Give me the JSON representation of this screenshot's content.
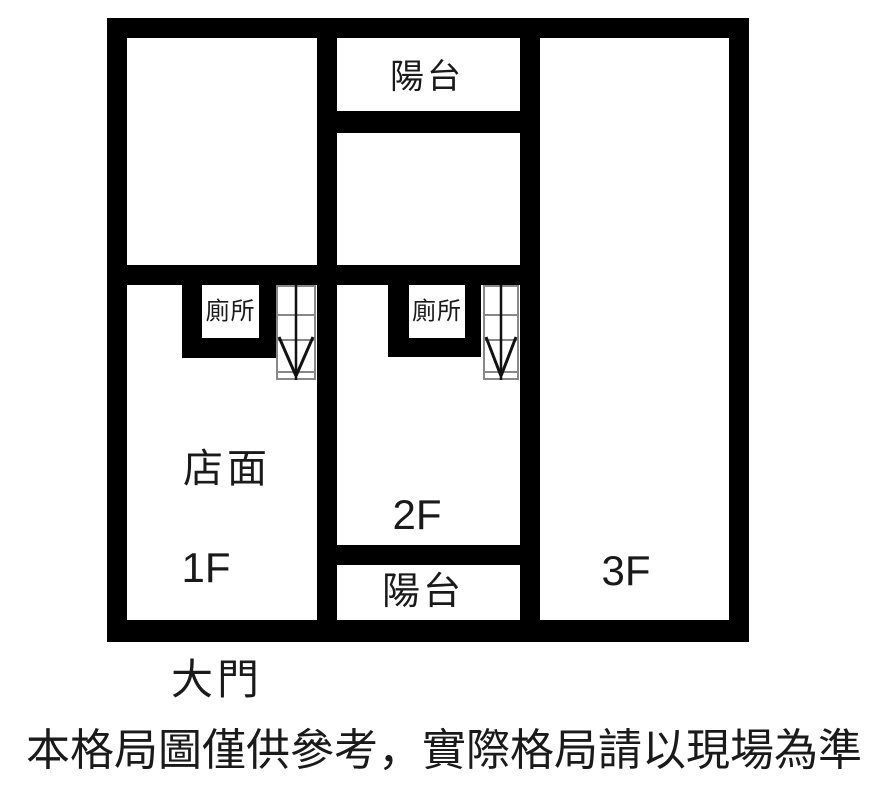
{
  "plan": {
    "rooms": {
      "balcony_top_label": "陽台",
      "toilet_left_label": "廁所",
      "toilet_middle_label": "廁所",
      "storefront_label": "店面",
      "floor_1_label": "1F",
      "floor_2_label": "2F",
      "floor_3_label": "3F",
      "balcony_bottom_label": "陽台"
    },
    "main_door_label": "大門"
  },
  "disclaimer": "本格局圖僅供參考，實際格局請以現場為準",
  "colors": {
    "wall": "#000000",
    "background": "#ffffff",
    "text": "#1a1a1a",
    "stair_tread": "#888888",
    "stair_arrow": "#111111"
  }
}
